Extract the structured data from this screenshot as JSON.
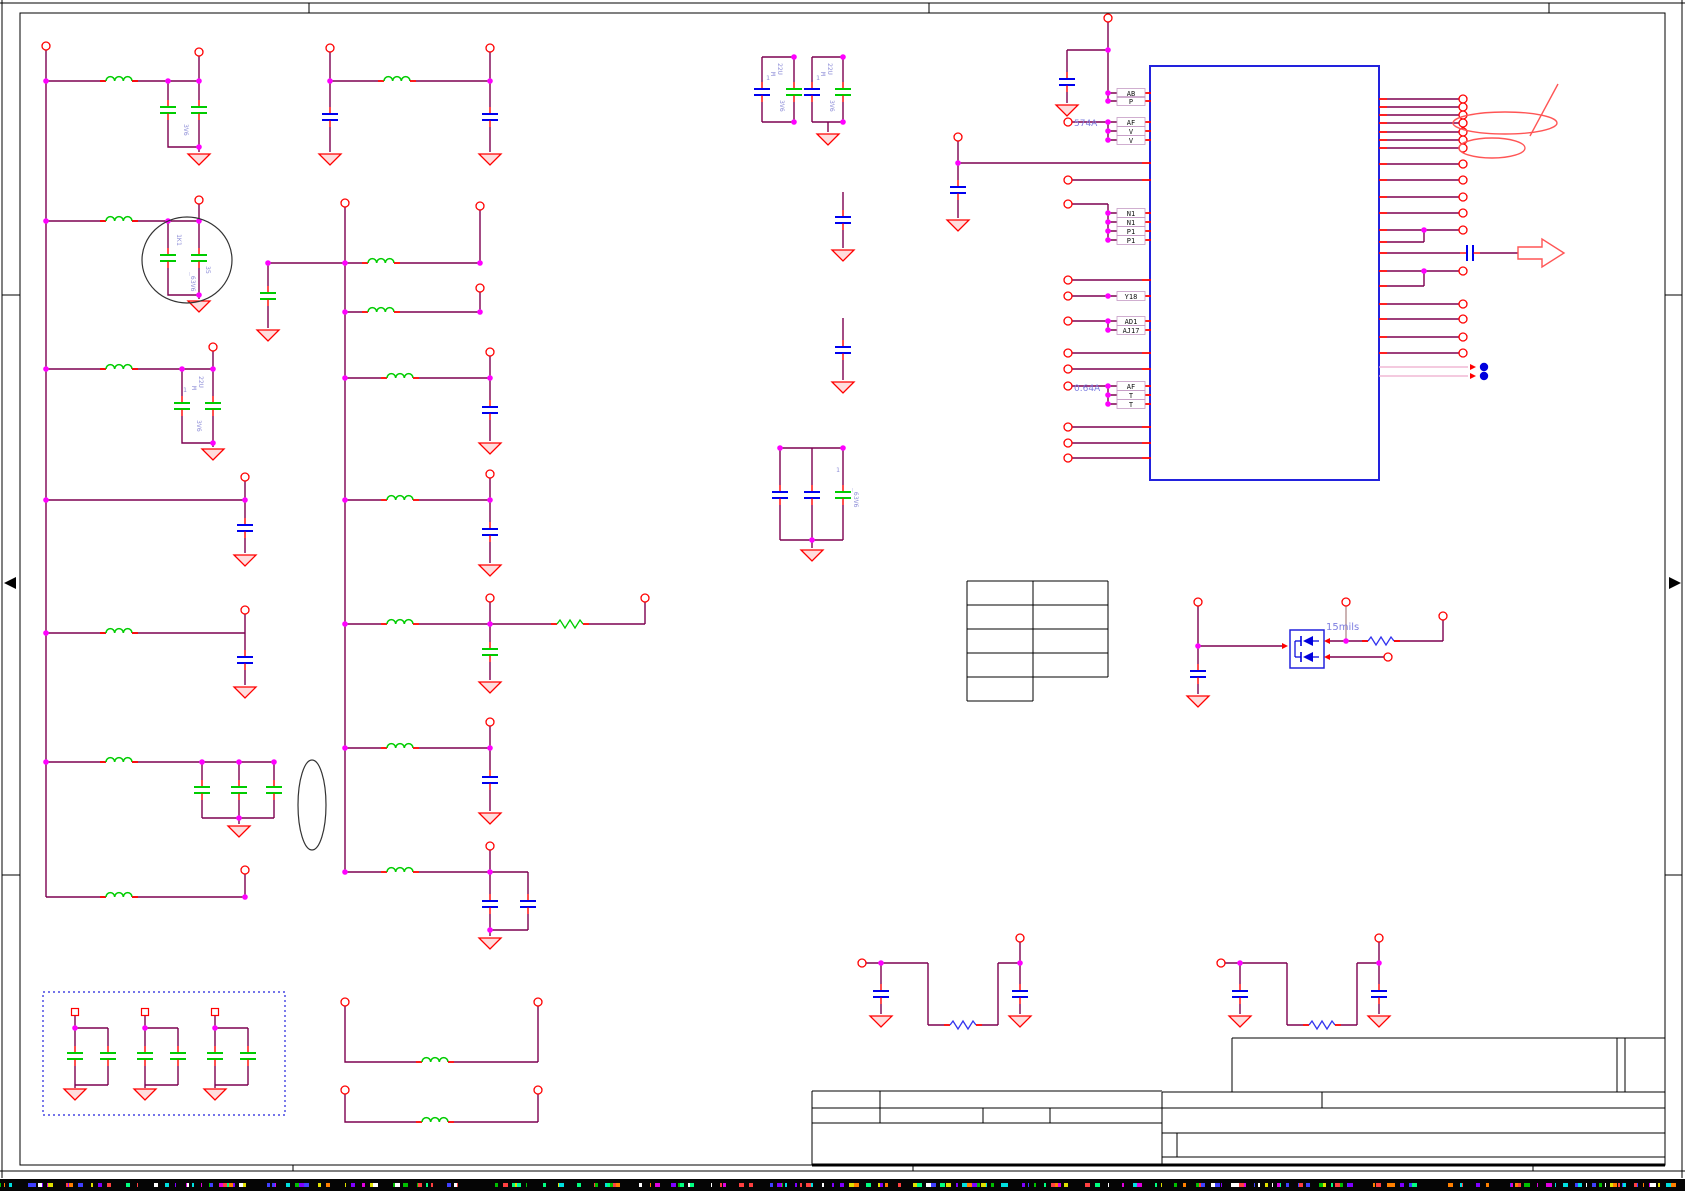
{
  "app": {
    "type": "schematic-editor-sheet"
  },
  "colors": {
    "wire": "#7d0050",
    "terminal_red": "#ff0000",
    "ferrite_green": "#00cc00",
    "component_blue": "#0000ee",
    "junction_magenta": "#ff00ff",
    "ic_outline": "#2222dd",
    "annotation_text": "#7d7de0",
    "value_text": "#8f8fd8",
    "frame_black": "#000000",
    "faint_net_pink": "#eeaacc",
    "noise": [
      "#00e0e0",
      "#e000e0",
      "#e0e000",
      "#00c000",
      "#ff4040",
      "#4040ff",
      "#ffffff",
      "#ff8000",
      "#00ff80",
      "#8000ff"
    ]
  },
  "ic_pins": {
    "ab": "AB",
    "p": "P",
    "af1": "AF",
    "v1": "V",
    "v2": "V",
    "n1a": "N1",
    "n1b": "N1",
    "p1a": "P1",
    "p1b": "P1",
    "y18": "Y18",
    "ad1": "AD1",
    "aj17": "AJ17",
    "af2": "AF",
    "t1": "T",
    "t2": "T"
  },
  "notes": {
    "current_top": "574A",
    "current_mid": "0.64A",
    "trace_width": "15mils"
  },
  "values": {
    "v3v6": "3V6",
    "ref_1k1": "1K1",
    "v35": "35",
    "v63v6": "_63V6",
    "v22u": "22U",
    "m": "M",
    "one": "1"
  }
}
